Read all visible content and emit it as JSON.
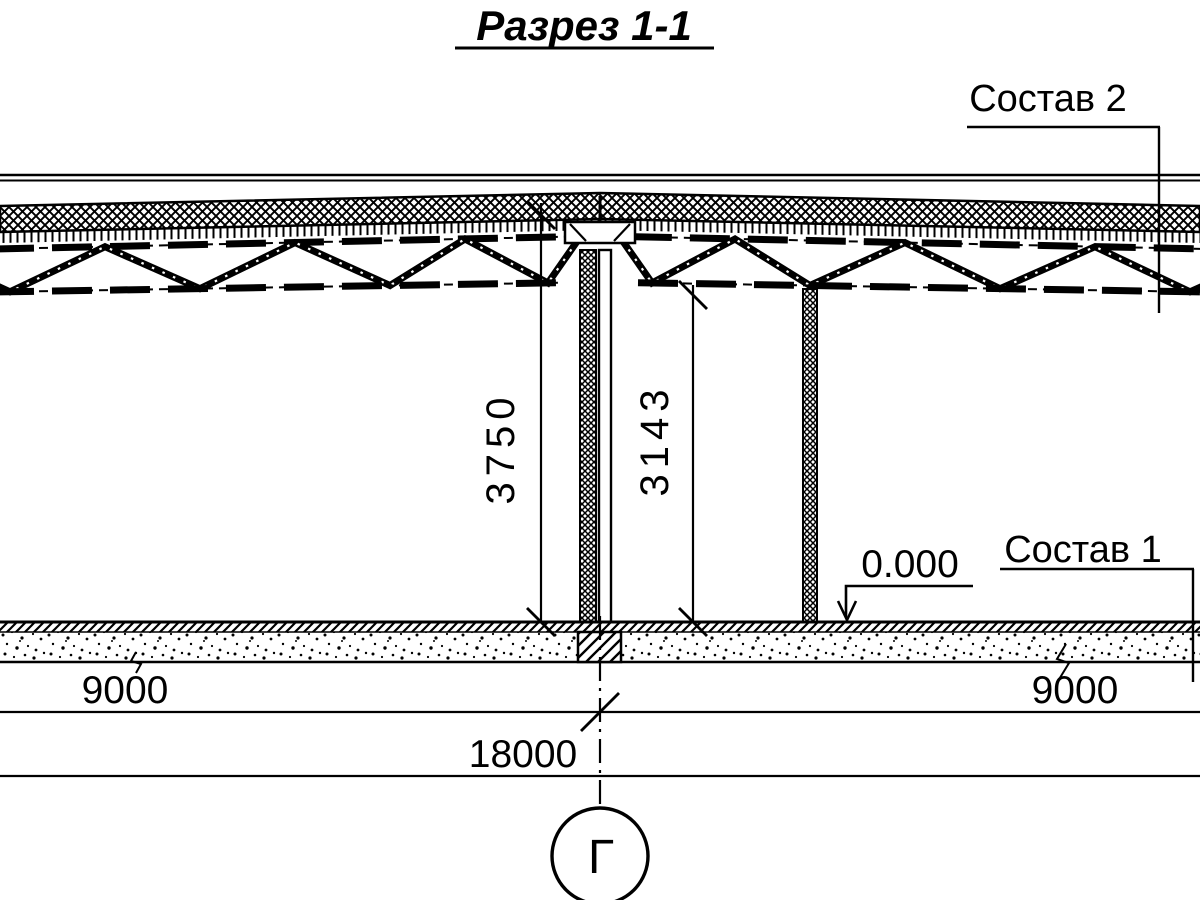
{
  "title": {
    "text": "Разрез 1-1"
  },
  "callouts": {
    "roof_composition": "Состав 2",
    "floor_composition": "Состав 1"
  },
  "elevation_mark": {
    "value": "0.000"
  },
  "dimensions": {
    "height_floor_to_ridge_mm": "3750",
    "height_floor_to_truss_mm": "3143",
    "span_left_mm": "9000",
    "span_right_mm": "9000",
    "span_total_mm": "18000"
  },
  "grid_axis": {
    "label": "Г"
  },
  "colors": {
    "ink": "#000000",
    "paper": "#ffffff"
  }
}
